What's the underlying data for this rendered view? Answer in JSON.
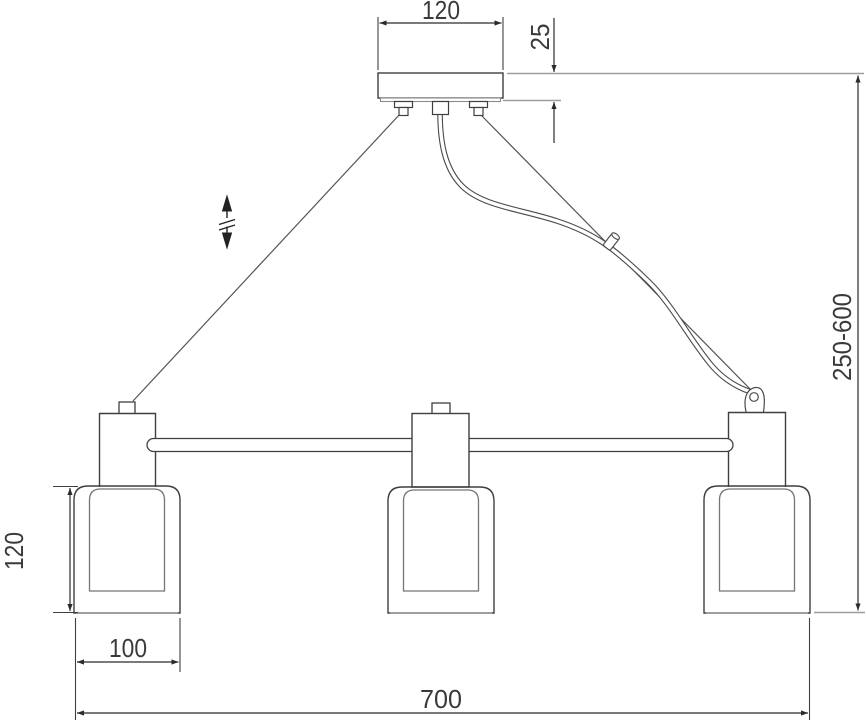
{
  "meta": {
    "title": "Pendant chandelier with three cylindrical shades — dimensional line drawing",
    "view": "front elevation",
    "units_shown": "mm"
  },
  "dimensions": {
    "canopy_width": "120",
    "canopy_height": "25",
    "suspension_height_range": "250-600",
    "shade_height": "120",
    "shade_width": "100",
    "overall_width": "700"
  },
  "symbols": {
    "height_adjust": "double-headed vertical arrow with break marks (adjustable height)"
  },
  "colors": {
    "line": "#3f3f3f",
    "auxiliary_line": "#9e9e9e",
    "inner_glass_line": "#757575",
    "cable_line": "#555555",
    "text": "#3a3a3a",
    "background": "#ffffff"
  }
}
